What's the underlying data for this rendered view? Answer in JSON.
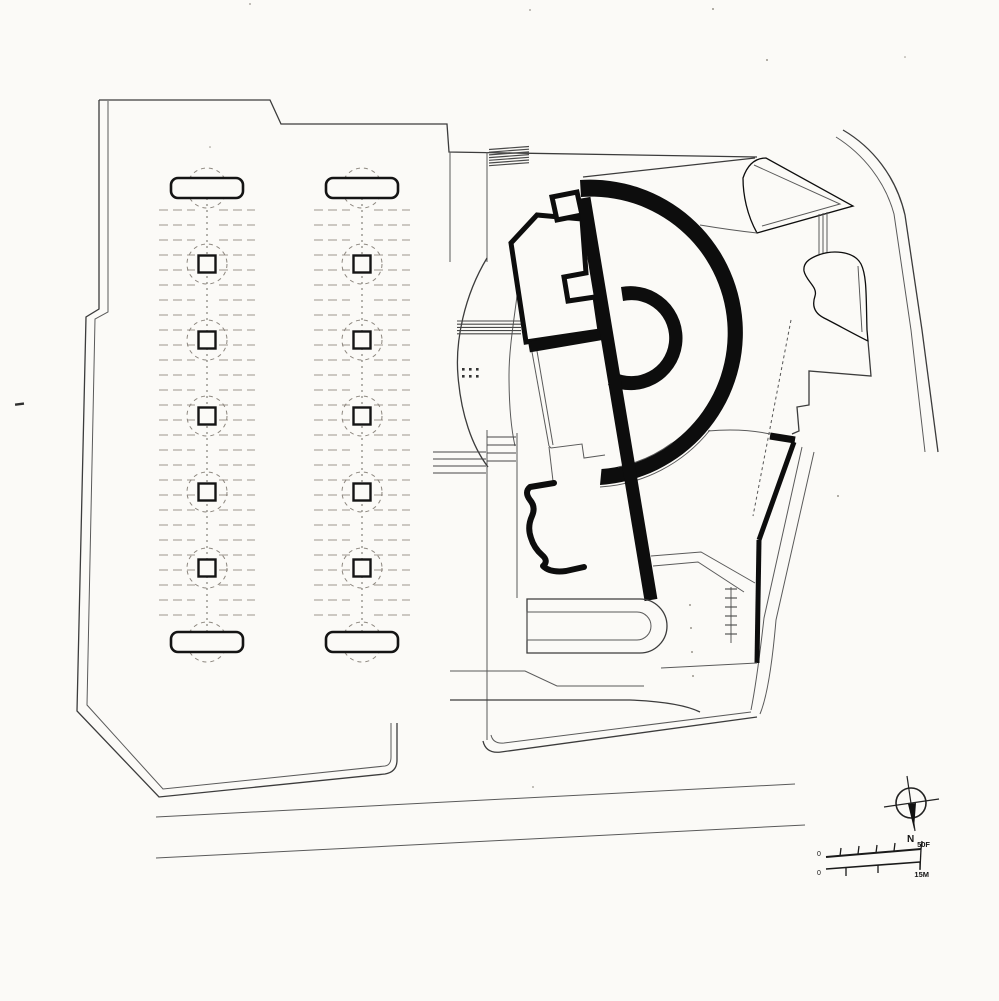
{
  "document": {
    "type": "architectural-site-plan",
    "description": "Black ink site plan drawing on white paper: two tree-lined parking bays on the left, a museum-like building with a large circular fan-shaped wing and tilted linear slab in the center-right, surrounding streets, a north arrow and a graphic scale bar at lower right"
  },
  "colors": {
    "paper": "#fbfaf7",
    "ink_heavy": "#0d0d0d",
    "ink_thin": "#3c3c3c",
    "ink_faint": "#a8a199"
  },
  "annotations": {
    "north_label": "N",
    "scale_feet_label": "50F",
    "scale_meters_label": "15M",
    "scale_zero_top": "0",
    "scale_zero_bottom": "0"
  },
  "icons": {
    "north_arrow": "compass-circle-with-needle",
    "scale_bar": "dual-unit-graphic-scale"
  },
  "parking": {
    "strip_centers": [
      207,
      362
    ],
    "tree_ys": [
      264,
      340,
      416,
      492,
      568
    ],
    "pill": {
      "top_y": 178,
      "bottom_y": 632,
      "width": 72,
      "height": 20
    },
    "stalls": {
      "y_start": 210,
      "y_step": 15,
      "rows": 28,
      "inner_gap": 12,
      "half_span": 48
    },
    "tree_square": 17,
    "tree_canopy_r": 20
  },
  "details": {
    "crosswalk": {
      "x": 489,
      "width": 40,
      "y_start": 148,
      "lines": 7,
      "step": 2.7
    },
    "lens_stairs": {
      "x1": 457,
      "x2": 521,
      "y_start": 321,
      "lines": 5,
      "step": 3.2
    },
    "neck_steps": {
      "x1": 487,
      "x2": 516,
      "y_start": 437,
      "lines": 4,
      "step": 8
    },
    "left_bands": {
      "x1": 433,
      "x2": 486,
      "y_start": 452,
      "lines": 4,
      "step": 7
    },
    "terrace_stairs": {
      "x": 731,
      "y_start": 589,
      "ticks": 6,
      "step": 9,
      "half": 6
    },
    "plaza_dots_x": [
      462,
      469,
      476
    ],
    "plaza_dots_y": [
      368,
      375
    ]
  }
}
